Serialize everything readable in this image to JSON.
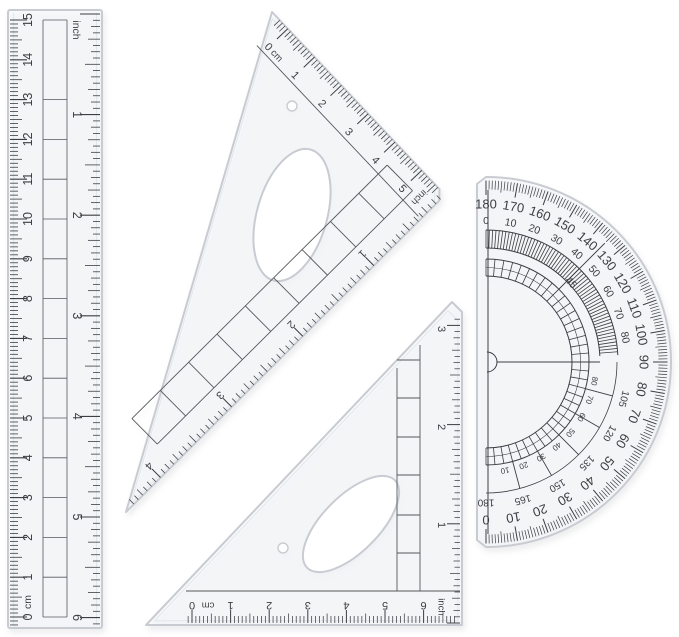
{
  "colors": {
    "ink": "#3b3e42",
    "ink_soft": "#55585c",
    "plastic_edge": "#c8ccd2",
    "plastic_bevel": "#e2e5ea",
    "plastic_fill": "rgba(247,249,251,0.6)",
    "background": "#ffffff"
  },
  "ruler": {
    "cm_scale": {
      "unit_label": "cm",
      "numbers": [
        "0",
        "1",
        "2",
        "3",
        "4",
        "5",
        "6",
        "7",
        "8",
        "9",
        "10",
        "11",
        "12",
        "13",
        "14",
        "15"
      ]
    },
    "inch_scale": {
      "unit_label": "inch",
      "numbers": [
        "1",
        "2",
        "3",
        "4",
        "5",
        "6"
      ]
    }
  },
  "large_set_square": {
    "cm_scale": {
      "unit_label": "cm",
      "numbers": [
        "0",
        "1",
        "2",
        "3",
        "4",
        "5"
      ]
    },
    "inch_scale": {
      "unit_label": "inch",
      "numbers": [
        "1",
        "2",
        "3",
        "4"
      ]
    }
  },
  "small_set_square": {
    "cm_scale": {
      "unit_label": "cm",
      "numbers": [
        "0",
        "1",
        "2",
        "3",
        "4",
        "5",
        "6"
      ]
    },
    "inch_scale": {
      "unit_label": "inch",
      "numbers": [
        "1",
        "2",
        "3"
      ]
    }
  },
  "protractor": {
    "outer_scale": [
      180,
      170,
      160,
      150,
      140,
      130,
      120,
      110,
      100,
      90,
      80,
      70,
      60,
      50,
      40,
      30,
      20,
      10,
      0
    ],
    "inner_scale_upper": [
      0,
      10,
      20,
      30,
      40,
      50,
      60,
      70,
      80
    ],
    "inner_scale_lower": [
      105,
      120,
      135,
      150,
      165,
      180
    ],
    "complement_scale_lower": [
      10,
      20,
      30,
      40,
      50,
      60,
      70,
      80
    ],
    "diagonal_label": "45"
  }
}
